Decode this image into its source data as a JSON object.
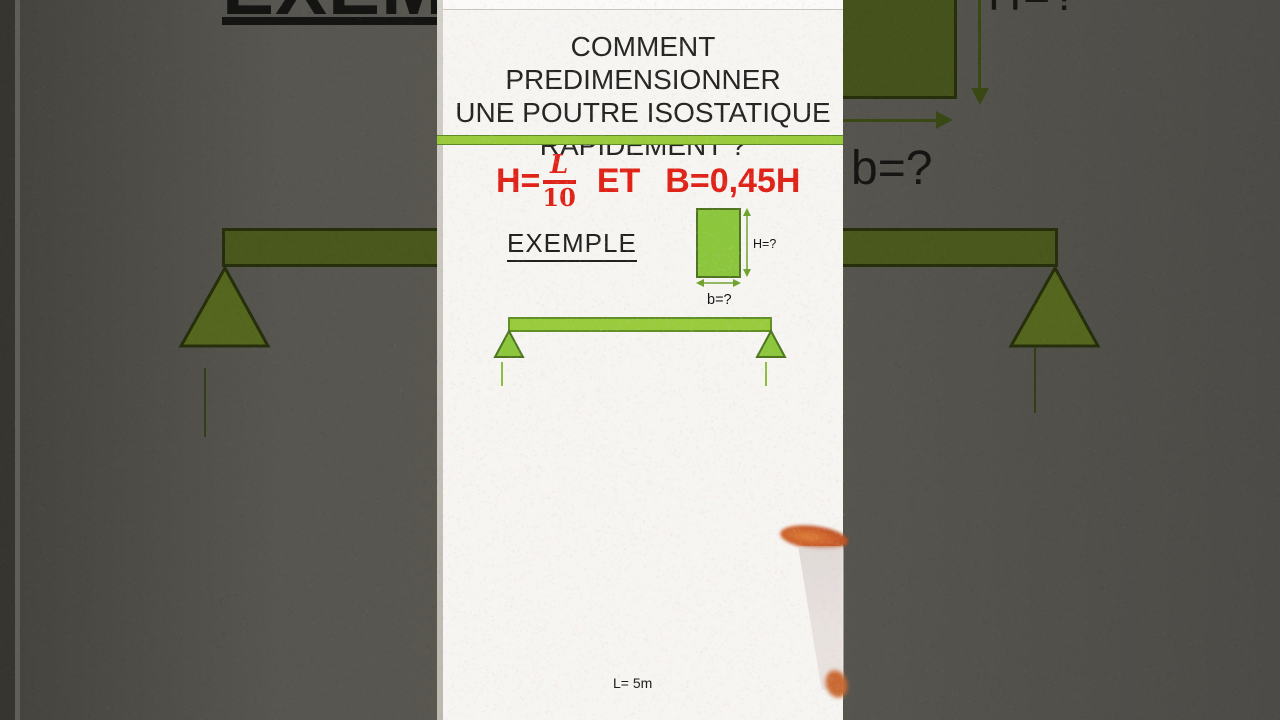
{
  "panel": {
    "title_lines": {
      "line1": "COMMENT PREDIMENSIONNER",
      "line2": "UNE POUTRE ISOSTATIQUE",
      "line3": "RAPIDEMENT ?"
    },
    "formula": {
      "lhs": "H=",
      "numerator": "L",
      "denominator": "10",
      "conjunction": "ET",
      "rhs": "B=0,45H"
    },
    "example_label": "EXEMPLE",
    "section": {
      "height_label": "H=?",
      "width_label": "b=?"
    },
    "beam": {
      "span_label": "L= 5m"
    }
  },
  "background": {
    "example_label_cut": "EXEMPLE",
    "height_label_cut": "H=?",
    "width_label": "b=?"
  },
  "colors": {
    "bright_green": "#9acb3c",
    "section_green": "#8cc63c",
    "green_border": "#4e741f",
    "dark_olive": "#4a571d",
    "dark_olive_border": "#262f0c",
    "formula_red": "#e02318",
    "panel_bg": "#f7f5f2",
    "backdrop_gray": "#585650"
  }
}
